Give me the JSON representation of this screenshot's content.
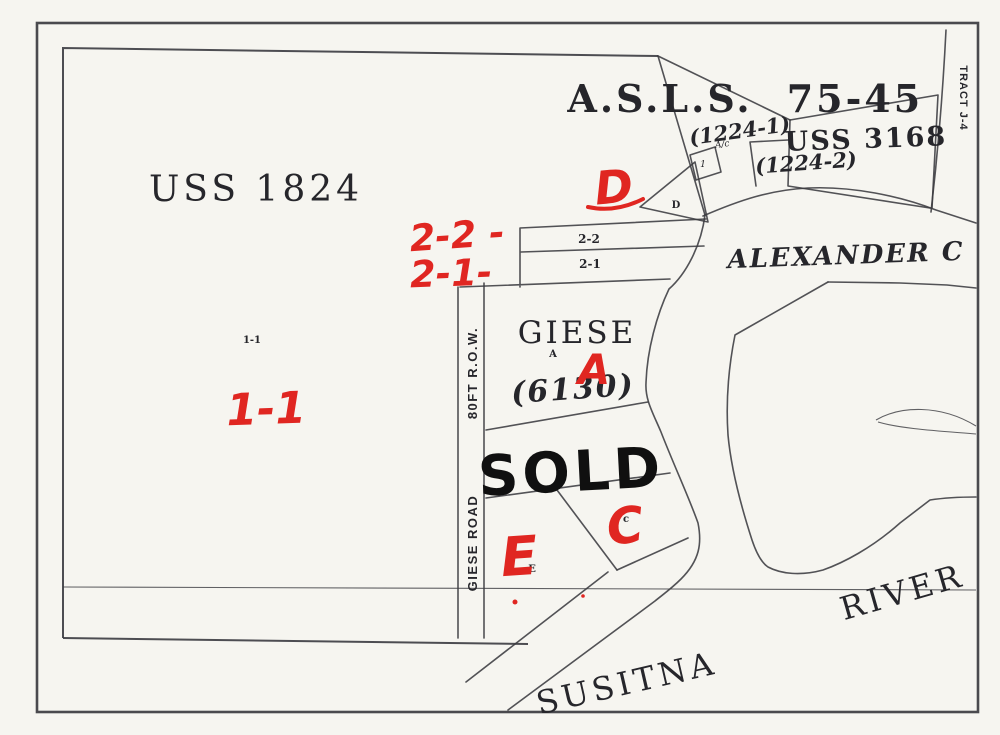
{
  "map": {
    "printed": {
      "asls": "A.S.L.S.",
      "asls_no": "75-45",
      "p1224_1": "(1224-1)",
      "ac": "A/c",
      "p1224_2": "(1224-2)",
      "uss3168": "USS 3168",
      "tract_j4": "TRACT J-4",
      "uss1824": "USS 1824",
      "alexander": "ALEXANDER C",
      "strip_2_2": "2-2",
      "strip_2_1": "2-1",
      "giese": "GIESE",
      "a_small": "A",
      "p6130": "(6130)",
      "one_one_small": "1-1",
      "road_name": "GIESE ROAD",
      "road_row": "80FT R.O.W.",
      "e_small": "E",
      "c_small": "c",
      "d_small": "D",
      "one_small": "1",
      "susitna": "SUSITNA",
      "river": "RIVER"
    },
    "handwritten_red": {
      "d": "D",
      "strip_2_2": "2-2 -",
      "strip_2_1": "2-1-",
      "one_one": "1-1",
      "a": "A",
      "c": "C",
      "e": "E"
    },
    "handwritten_black": {
      "sold": "SOLD"
    },
    "colors": {
      "paper": "#f6f5f0",
      "map_line": "#3b3b40",
      "print_ink": "#26262b",
      "red_ink": "#e02621",
      "marker_ink": "#101010"
    }
  }
}
